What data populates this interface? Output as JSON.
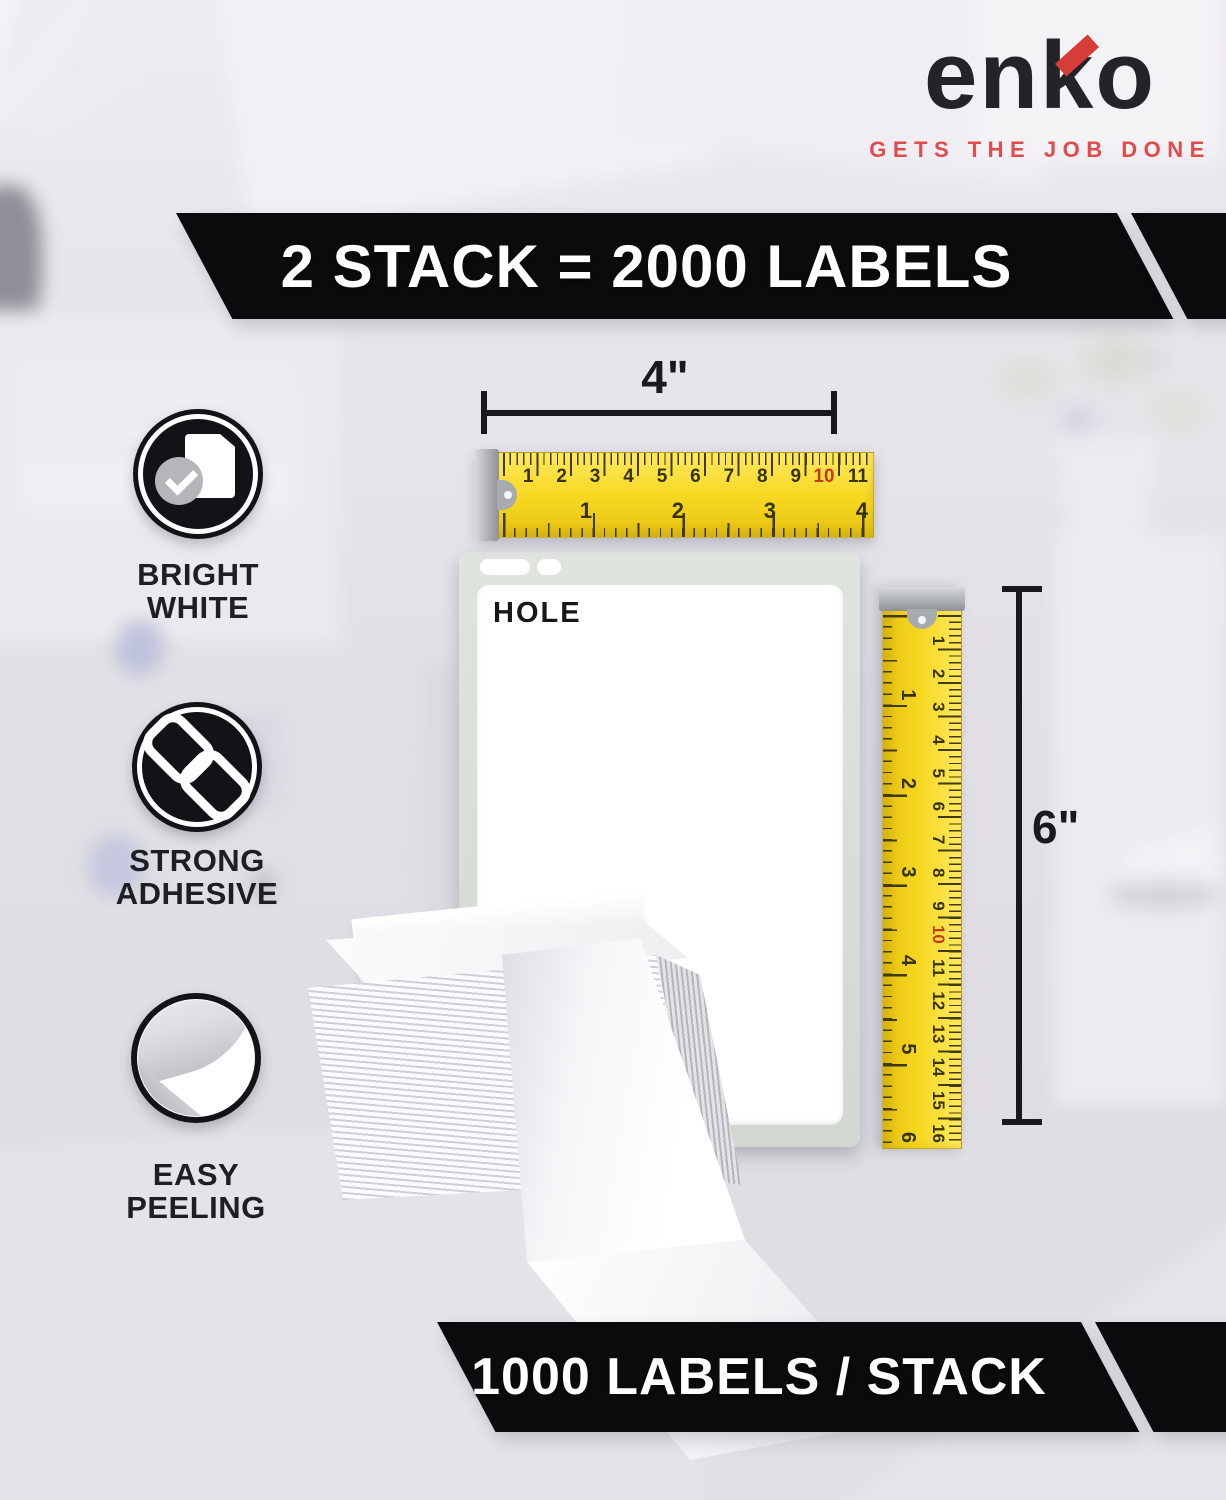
{
  "brand": {
    "name": "enko",
    "part1": "en",
    "part2": "k",
    "part3": "o",
    "tagline": "GETS THE JOB DONE"
  },
  "banners": {
    "top": "2 STACK = 2000 LABELS",
    "bottom": "1000 LABELS / STACK"
  },
  "features": [
    {
      "icon": "document-check",
      "line1": "BRIGHT",
      "line2": "WHITE"
    },
    {
      "icon": "chain-link",
      "line1": "STRONG",
      "line2": "ADHESIVE"
    },
    {
      "icon": "peeling-label",
      "line1": "EASY",
      "line2": "PEELING"
    }
  ],
  "diagram": {
    "hole_label": "HOLE",
    "width_label": "4\"",
    "height_label": "6\"",
    "ruler_h": {
      "cm_numbers": [
        "1",
        "2",
        "3",
        "4",
        "5",
        "6",
        "7",
        "8",
        "9",
        "10",
        "11"
      ],
      "inch_numbers": [
        "1",
        "2",
        "3",
        "4"
      ],
      "highlight_number": "10"
    },
    "ruler_v": {
      "cm_numbers": [
        "1",
        "2",
        "3",
        "4",
        "5",
        "6",
        "7",
        "8",
        "9",
        "10",
        "11",
        "12",
        "13",
        "14",
        "15",
        "16"
      ],
      "inch_numbers": [
        "1",
        "2",
        "3",
        "4",
        "5",
        "6"
      ],
      "highlight_number": "10"
    }
  },
  "colors": {
    "accent_red": "#d63c38",
    "tagline_red": "#e04c4c",
    "ribbon_black": "#0b0b0d",
    "ruler_yellow": "#f6d71f",
    "backing_gray": "#d8dcd4"
  }
}
